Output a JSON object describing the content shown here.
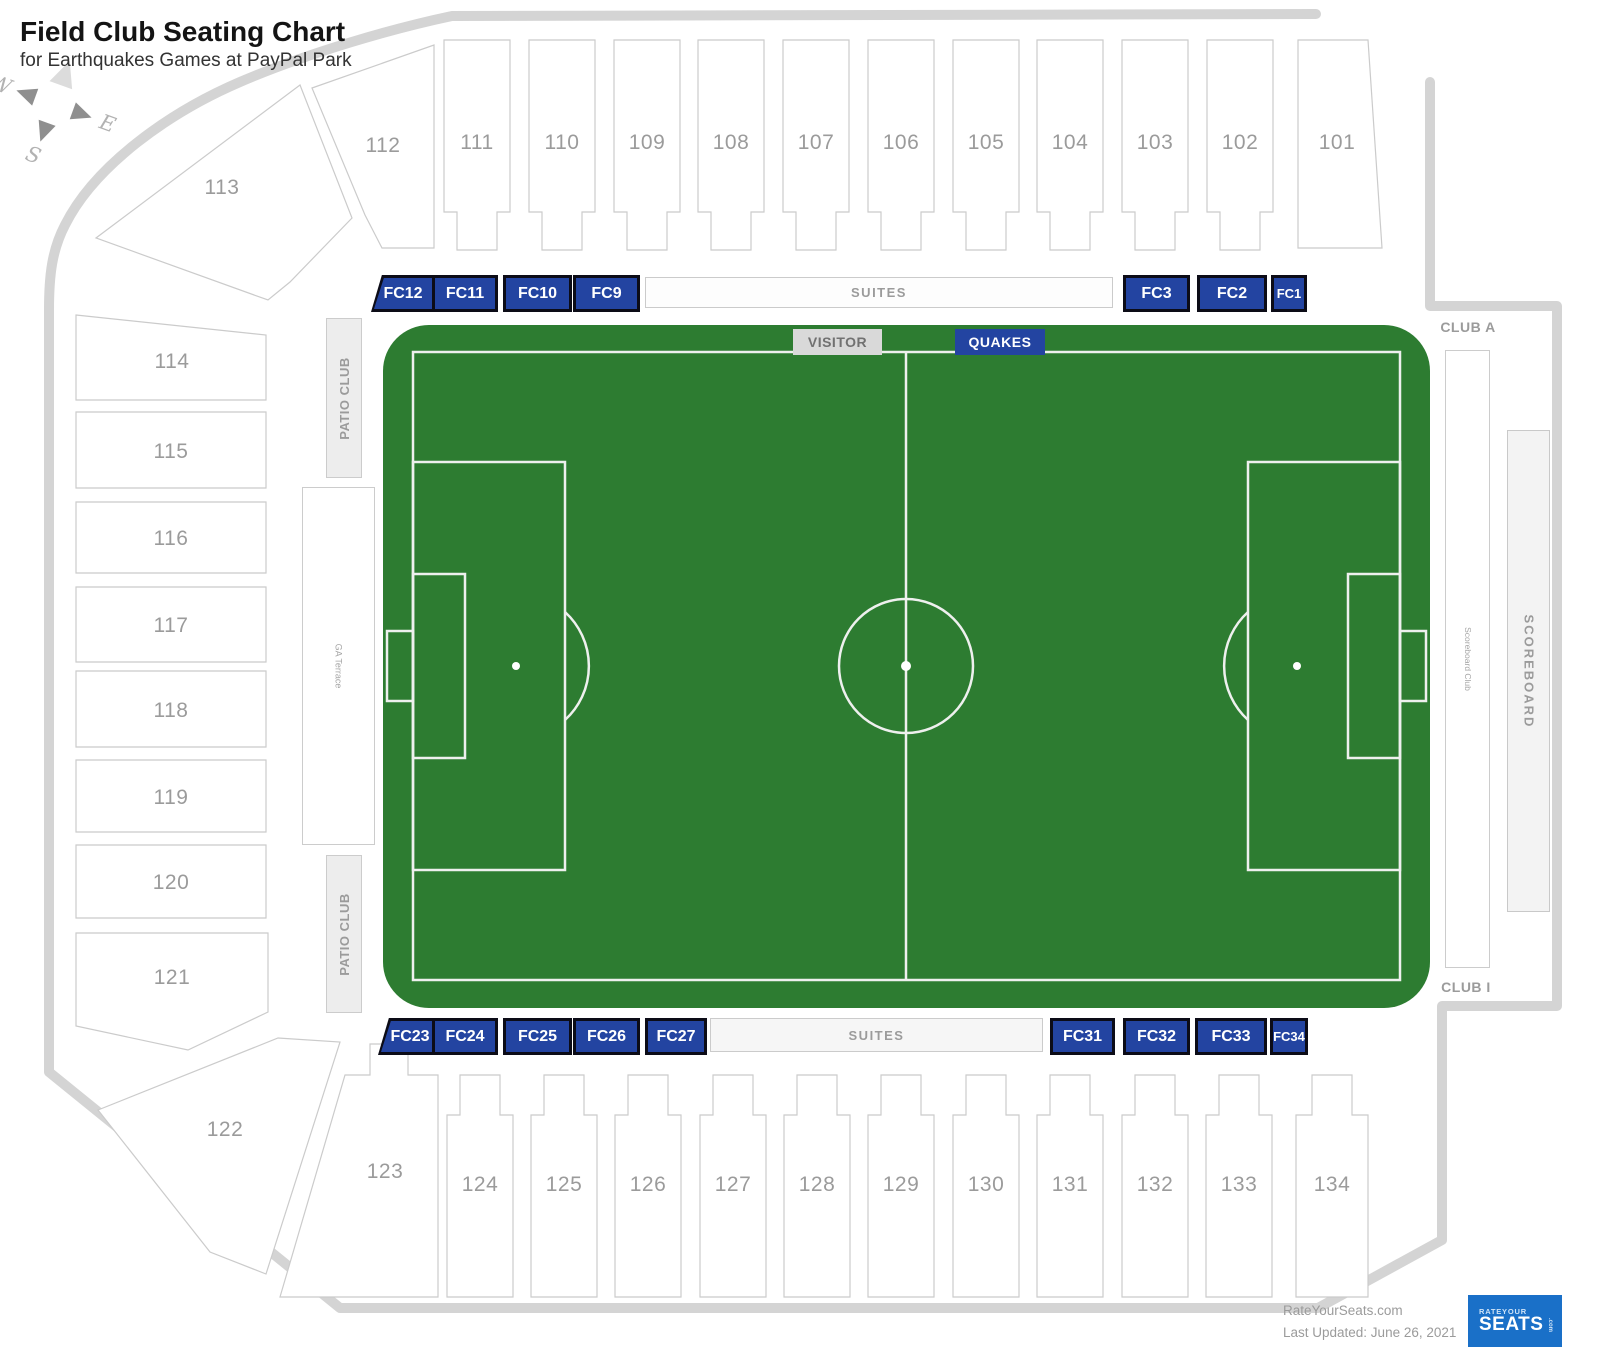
{
  "title": "Field Club Seating Chart",
  "subtitle": "for Earthquakes Games at PayPal Park",
  "compass": {
    "w": "W",
    "e": "E",
    "s": "S"
  },
  "stands": {
    "top": [
      "112",
      "111",
      "110",
      "109",
      "108",
      "107",
      "106",
      "105",
      "104",
      "103",
      "102",
      "101"
    ],
    "left": [
      "113",
      "114",
      "115",
      "116",
      "117",
      "118",
      "119",
      "120",
      "121",
      "122"
    ],
    "bottom": [
      "123",
      "124",
      "125",
      "126",
      "127",
      "128",
      "129",
      "130",
      "131",
      "132",
      "133",
      "134"
    ]
  },
  "field_clubs": {
    "top": [
      "FC12",
      "FC11",
      "FC10",
      "FC9",
      "FC3",
      "FC2",
      "FC1"
    ],
    "bottom": [
      "FC23",
      "FC24",
      "FC25",
      "FC26",
      "FC27",
      "FC31",
      "FC32",
      "FC33",
      "FC34"
    ]
  },
  "suites": {
    "top": "SUITES",
    "bottom": "SUITES"
  },
  "pitch": {
    "visitor": "VISITOR",
    "home": "QUAKES"
  },
  "areas": {
    "patio_upper": "PATIO CLUB",
    "patio_lower": "PATIO CLUB",
    "ga_terrace": "GA Terrace",
    "club_a": "CLUB A",
    "club_i": "CLUB I",
    "scoreboard": "SCOREBOARD",
    "scoreboard_club": "Scoreboard Club"
  },
  "footer": {
    "site": "RateYourSeats.com",
    "updated": "Last Updated: June 26, 2021",
    "logo": {
      "top": "RATEYOUR",
      "main": "SEATS",
      "suffix": ".com"
    }
  },
  "colors": {
    "fc_blue": "#2344a1",
    "pitch_green": "#2d7c31",
    "pitch_line": "#eef0ee",
    "visitor_gray": "#d9d9d9",
    "outline_gray": "#d4d4d4",
    "logo_blue": "#1a70c8",
    "logo_orange": "#f26a21"
  }
}
